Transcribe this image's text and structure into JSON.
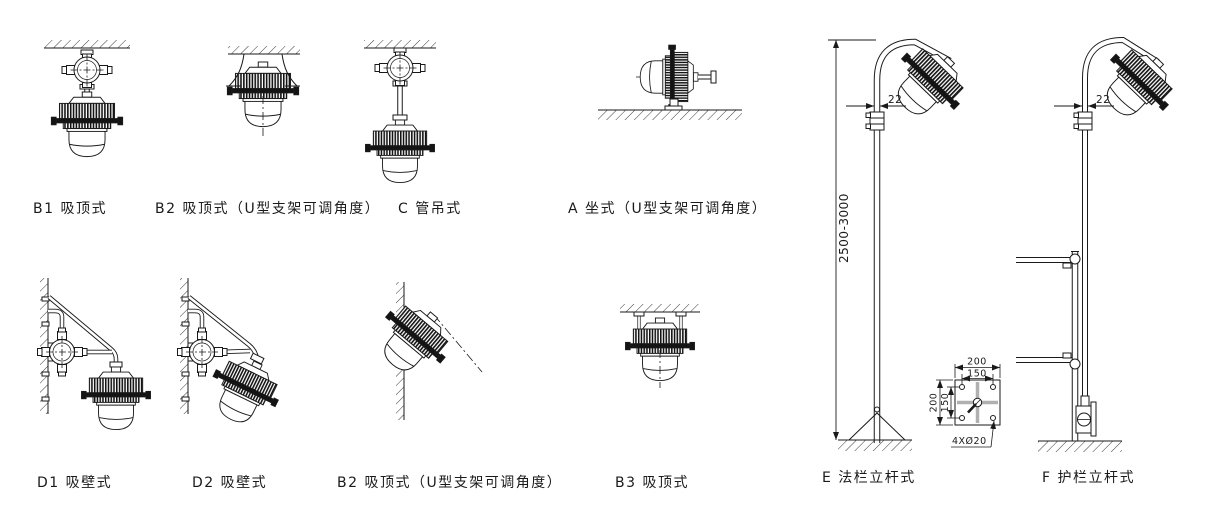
{
  "figures": {
    "b1": {
      "label": "B1 吸顶式"
    },
    "b2_top": {
      "label": "B2 吸顶式（U型支架可调角度）"
    },
    "c": {
      "label": "C 管吊式"
    },
    "a": {
      "label": "A 坐式（U型支架可调角度）"
    },
    "d1": {
      "label": "D1 吸壁式"
    },
    "d2": {
      "label": "D2 吸壁式"
    },
    "b2_wall": {
      "label": "B2 吸顶式（U型支架可调角度）"
    },
    "b3": {
      "label": "B3 吸顶式"
    },
    "e": {
      "label": "E 法栏立杆式"
    },
    "f": {
      "label": "F 护栏立杆式"
    }
  },
  "dimensions": {
    "pole_height": "2500-3000",
    "pole_diameter_e": "22",
    "pole_diameter_f": "22",
    "plate_width_top": "200",
    "plate_hole_spacing_top": "150",
    "plate_height_left": "200",
    "plate_hole_spacing_left": "150",
    "plate_holes": "4XØ20"
  },
  "colors": {
    "line": "#1a1a1a",
    "background": "#ffffff",
    "dim_gray": "#b0b0b0"
  }
}
